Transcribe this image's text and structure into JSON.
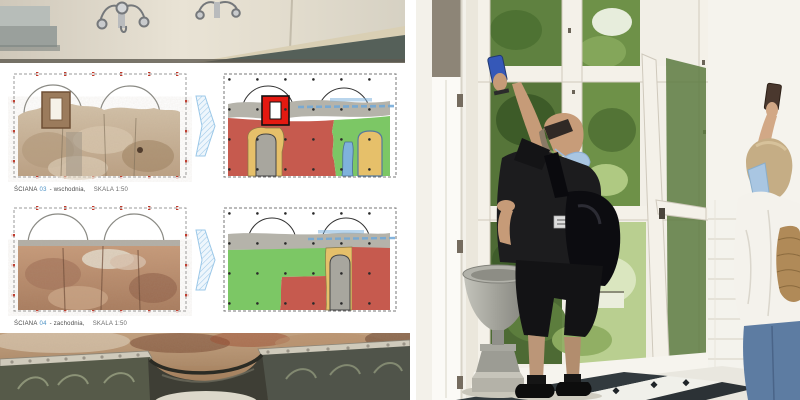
{
  "left_collage": {
    "captions": [
      {
        "wall_label": "ŚCIANA",
        "wall_number": "03",
        "orientation": "- wschodnia,",
        "scale": "SKALA 1:50"
      },
      {
        "wall_label": "ŚCIANA",
        "wall_number": "04",
        "orientation": "- zachodnia,",
        "scale": "SKALA 1:50"
      }
    ],
    "zone_colors": {
      "red": "#c65a4e",
      "green": "#7cc765",
      "yellow": "#e6c06a",
      "blue": "#7fb2dc",
      "gray_band": "#b5b3aa",
      "gray_block": "#a8a69e",
      "highlight_red": "#e41911",
      "arrow_blue": "#9cc8e8"
    }
  },
  "right_photo": {
    "palette": {
      "mask_blue": "#a9c6e2",
      "phone_blue": "#3558b8",
      "jeans_blue": "#5d7ca2",
      "foliage_green": "#6e9148"
    }
  }
}
